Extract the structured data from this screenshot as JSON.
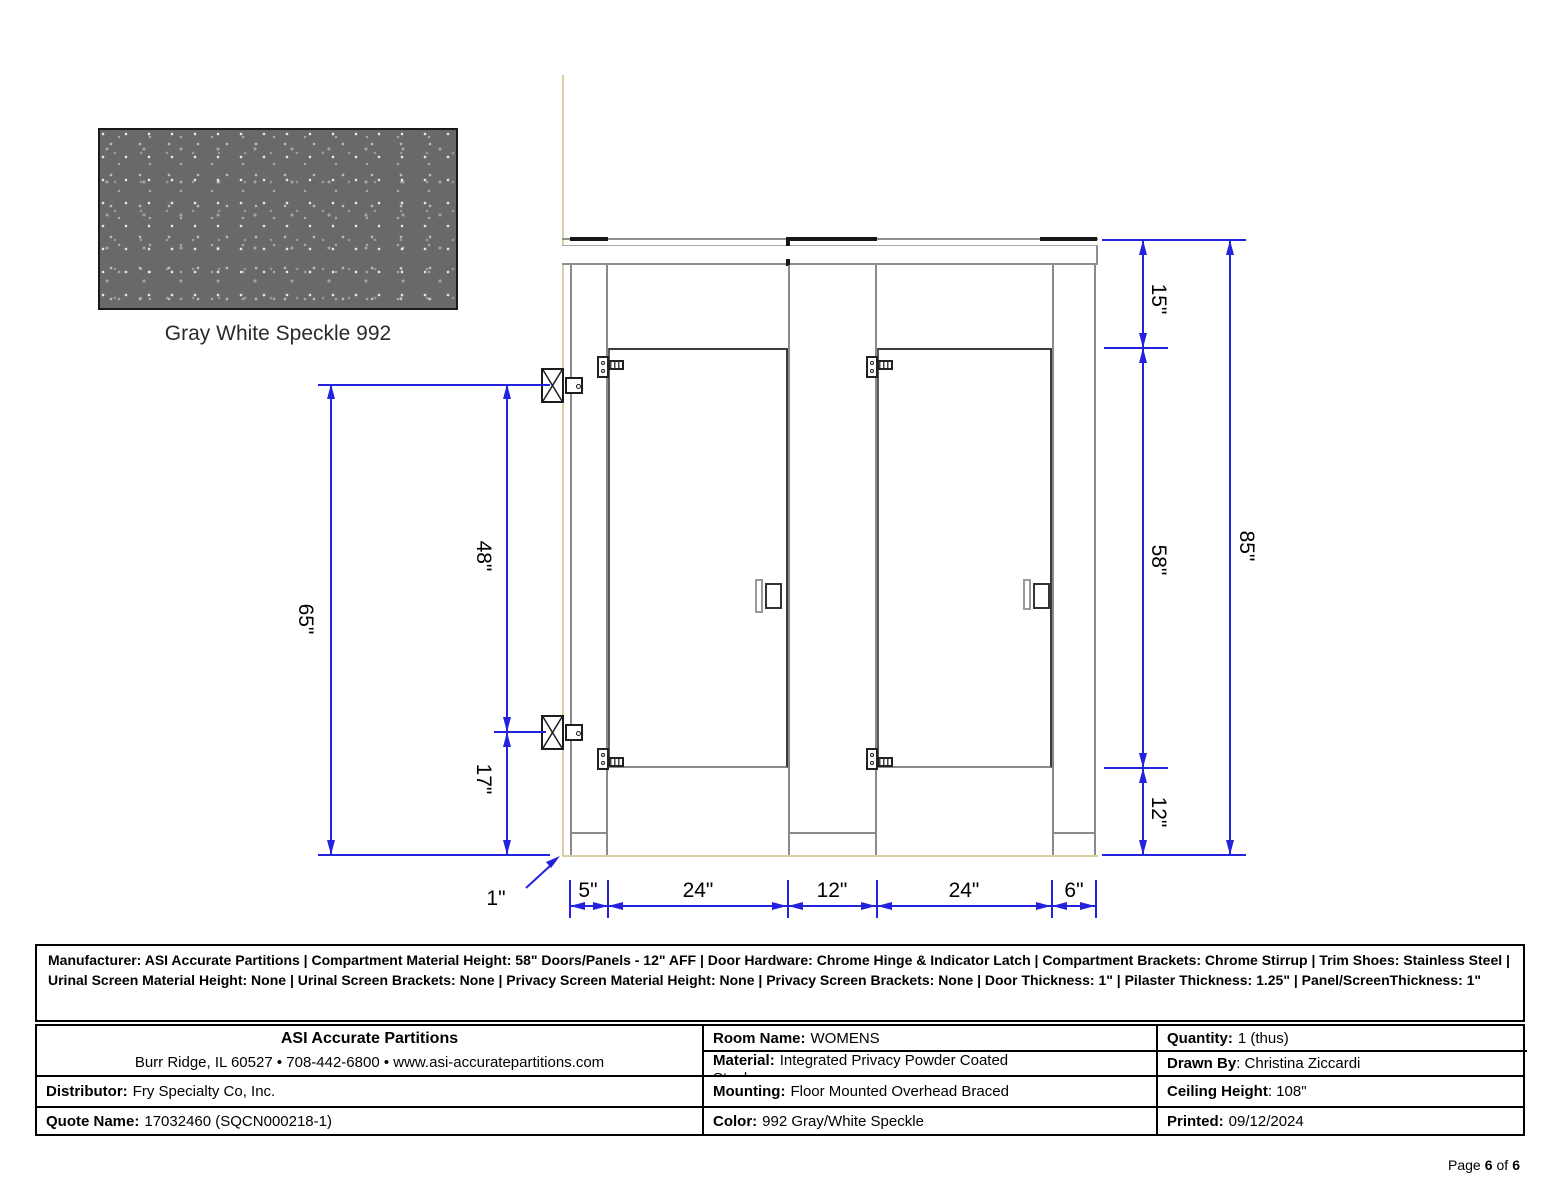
{
  "swatch": {
    "label": "Gray White Speckle 992",
    "base_color": "#696969"
  },
  "drawing": {
    "colors": {
      "dimension_blue": "#2323DE",
      "wall_tan": "#D9CFA2",
      "line_gray": "#8f8f8f"
    },
    "dims": {
      "left_total": "65\"",
      "left_upper": "48\"",
      "left_lower": "17\"",
      "right_top": "15\"",
      "right_mid": "58\"",
      "right_bottom": "12\"",
      "right_total": "85\"",
      "wall_gap": "1\"",
      "bottom_pilaster1": "5\"",
      "bottom_door1": "24\"",
      "bottom_pilaster2": "12\"",
      "bottom_door2": "24\"",
      "bottom_pilaster3": "6\""
    }
  },
  "info_box": {
    "text": "Manufacturer: ASI Accurate Partitions  |  Compartment Material Height: 58\" Doors/Panels - 12\" AFF  |  Door Hardware: Chrome Hinge & Indicator Latch  |  Compartment Brackets: Chrome Stirrup  |  Trim Shoes: Stainless Steel  |  Urinal Screen Material Height: None  |  Urinal Screen Brackets: None  |  Privacy Screen Material Height: None  |  Privacy Screen Brackets: None  |  Door Thickness: 1\"  |  Pilaster Thickness: 1.25\"  |  Panel/ScreenThickness: 1\""
  },
  "title_block": {
    "company_name": "ASI Accurate Partitions",
    "company_address": "Burr Ridge, IL 60527 • 708-442-6800 • www.asi-accuratepartitions.com",
    "distributor_label": "Distributor:",
    "distributor_value": "Fry Specialty Co, Inc.",
    "quote_label": "Quote Name:",
    "quote_value": "17032460 (SQCN000218-1)",
    "room_label": "Room Name:",
    "room_value": "WOMENS",
    "material_label": "Material:",
    "material_value": "Integrated Privacy Powder Coated",
    "material_value_line2": "Steel",
    "mounting_label": "Mounting:",
    "mounting_value": "Floor Mounted Overhead Braced",
    "color_label": "Color:",
    "color_value": "992 Gray/White Speckle",
    "quantity_label": "Quantity:",
    "quantity_value": "1 (thus)",
    "drawnby_label": "Drawn By",
    "drawnby_value": ": Christina Ziccardi",
    "ceiling_label": "Ceiling Height",
    "ceiling_value": ": 108\"",
    "printed_label": "Printed:",
    "printed_value": "09/12/2024"
  },
  "footer": {
    "page_word": "Page",
    "page_num": "6",
    "of_word": "of",
    "page_total": "6"
  }
}
